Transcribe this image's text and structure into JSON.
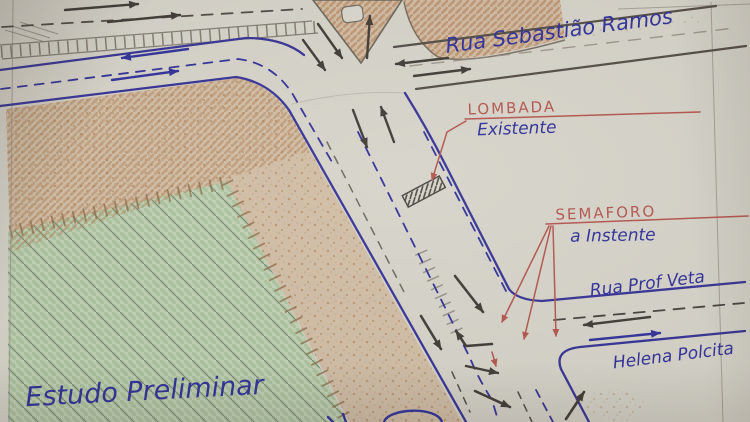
{
  "document": {
    "kind": "hand-drawn traffic study sketch (photographed paper plan)",
    "language": "Portuguese",
    "title": "Estudo Preliminar"
  },
  "streets": {
    "sebastiao_ramos": {
      "name": "Rua Sebastião Ramos"
    },
    "prof_veta": {
      "name_line1": "Rua Prof Veta",
      "name_line2": "Helena Polcita"
    }
  },
  "annotations": {
    "lombada": {
      "label": "LOMBADA",
      "note": "Existente"
    },
    "semaforo": {
      "label": "SEMAFORO",
      "note": "a Instente"
    }
  },
  "symbols": {
    "speed_bump": "hatched-bar-across-road",
    "flow_arrows": "black and blue hand-drawn directional arrows",
    "leader_arrows": "red leader lines pointing to signal locations",
    "median_hatch": "ladder hatching along curbs and medians"
  },
  "colors": {
    "paper": "#d6d3c9",
    "pencil": "#5a544b",
    "ink_blue": "#2e2e99",
    "ink_red": "#b2544c",
    "block_tan": "#c89a6f",
    "block_green": "#b3c9a7",
    "arrow_black": "#3e3a33"
  }
}
